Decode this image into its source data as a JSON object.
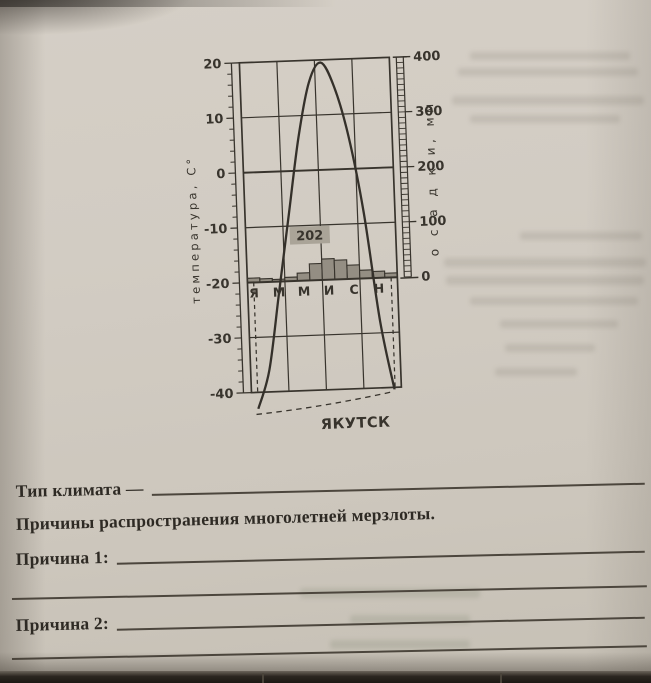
{
  "chart_data": {
    "type": "combo",
    "subtype": "climograph (line temperature + bar precipitation)",
    "station": "ЯКУТСК",
    "months_axis_labels": [
      "Я",
      "М",
      "М",
      "И",
      "С",
      "Н"
    ],
    "months_label_positions": [
      1,
      3,
      5,
      7,
      9,
      11
    ],
    "temp_axis": {
      "title": "температура, С°",
      "ticks": [
        20,
        10,
        0,
        -10,
        -20,
        -30,
        -40
      ],
      "range": [
        -40,
        20
      ]
    },
    "precip_axis": {
      "title": "о с а д к и,  мм",
      "ticks": [
        400,
        300,
        200,
        100,
        0
      ],
      "range": [
        0,
        400
      ]
    },
    "annotation_total_precip": "202",
    "series": [
      {
        "name": "temperature_c",
        "type": "line",
        "values": [
          -43,
          -36,
          -22,
          -8,
          6,
          16,
          19.5,
          15,
          6,
          -8,
          -28,
          -41
        ]
      },
      {
        "name": "precipitation_mm",
        "type": "bar",
        "values": [
          8,
          6,
          4,
          7,
          14,
          30,
          38,
          35,
          25,
          15,
          12,
          8
        ]
      }
    ],
    "grid": "on",
    "notes": "dashed vertical guides at January and December; dashed curve segment below -40 frame showing off-scale winter temperatures"
  },
  "form": {
    "climate_type_label": "Тип климата —",
    "heading": "Причины распространения многолетней мерзлоты.",
    "reason1_label": "Причина 1:",
    "reason2_label": "Причина 2:"
  },
  "colors": {
    "paper": "#d2ccc3",
    "ink": "#38342d",
    "bar_fill": "#948e83",
    "annotation_bg": "#aaa498",
    "form_line": "#4c463d"
  }
}
